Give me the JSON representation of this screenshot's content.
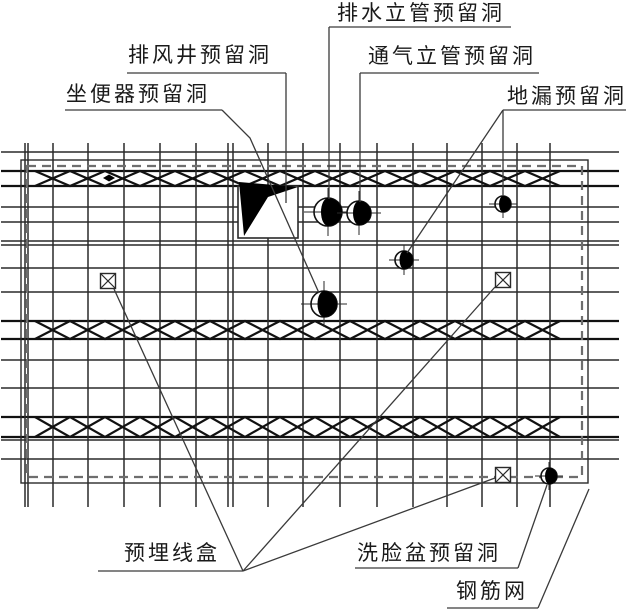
{
  "colors": {
    "line": "#2a2a2a",
    "bold_line": "#111111",
    "dashed_border": "#6e6e6e",
    "leader": "#3a3a3a",
    "text": "#1a1a1a",
    "fill": "#000000",
    "background": "#ffffff"
  },
  "labels": [
    {
      "id": "drain-riser-hole-label",
      "text": "排水立管预留洞",
      "tx": 337,
      "ty": 2,
      "underline": [
        329,
        27,
        511,
        27
      ],
      "leaders": [
        [
          [
            329,
            27
          ],
          [
            329,
            199
          ]
        ]
      ]
    },
    {
      "id": "exhaust-shaft-hole-label",
      "text": "排风井预留洞",
      "tx": 128,
      "ty": 44,
      "underline": [
        127,
        73,
        286,
        73
      ],
      "leaders": [
        [
          [
            286,
            73
          ],
          [
            286,
            203
          ]
        ]
      ]
    },
    {
      "id": "vent-riser-hole-label",
      "text": "通气立管预留洞",
      "tx": 368,
      "ty": 45,
      "underline": [
        360,
        73,
        539,
        73
      ],
      "leaders": [
        [
          [
            360,
            73
          ],
          [
            360,
            202
          ]
        ]
      ]
    },
    {
      "id": "toilet-hole-label",
      "text": "坐便器预留洞",
      "tx": 66,
      "ty": 83,
      "underline": [
        65,
        110,
        222,
        110
      ],
      "leaders": [
        [
          [
            222,
            110
          ],
          [
            250,
            138
          ],
          [
            319,
            293
          ]
        ]
      ]
    },
    {
      "id": "floor-drain-hole-label",
      "text": "地漏预留洞",
      "tx": 507,
      "ty": 85,
      "underline": [
        503,
        110,
        626,
        110
      ],
      "leaders": [
        [
          [
            503,
            110
          ],
          [
            503,
            196
          ]
        ],
        [
          [
            503,
            110
          ],
          [
            407,
            253
          ]
        ]
      ]
    },
    {
      "id": "embedded-junction-box-label",
      "text": "预埋线盒",
      "tx": 124,
      "ty": 542,
      "underline": [
        98,
        571,
        243,
        571
      ],
      "leaders": [
        [
          [
            243,
            571
          ],
          [
            114,
            289
          ]
        ],
        [
          [
            243,
            571
          ],
          [
            495,
            287
          ]
        ],
        [
          [
            243,
            571
          ],
          [
            495,
            478
          ]
        ]
      ]
    },
    {
      "id": "washbasin-hole-label",
      "text": "洗脸盆预留洞",
      "tx": 357,
      "ty": 542,
      "underline": [
        355,
        568,
        518,
        568
      ],
      "leaders": [
        [
          [
            518,
            568
          ],
          [
            547,
            485
          ]
        ]
      ]
    },
    {
      "id": "rebar-mesh-label",
      "text": "钢筋网",
      "tx": 456,
      "ty": 580,
      "underline": [
        447,
        608,
        538,
        608
      ],
      "leaders": [
        [
          [
            538,
            608
          ],
          [
            589,
            489
          ]
        ]
      ]
    }
  ],
  "slab": {
    "solid_border": [
      21,
      160,
      588,
      483
    ],
    "dashed_border": [
      27,
      166,
      582,
      477
    ],
    "grid": {
      "verticals": [
        25,
        28,
        53,
        88,
        124,
        160,
        196,
        228,
        233,
        268,
        303,
        340,
        377,
        413,
        447,
        482,
        517,
        550
      ],
      "v_top": 143,
      "v_bottom": 507,
      "horizontals": [
        152,
        207,
        222,
        241,
        245,
        268,
        292,
        360,
        388,
        440,
        459
      ],
      "bold_horizontals": [
        171,
        186,
        321,
        339,
        417,
        437
      ],
      "h_left": 1,
      "h_right": 619
    },
    "truss_bands": [
      {
        "y1": 171,
        "y2": 186
      },
      {
        "y1": 321,
        "y2": 339
      },
      {
        "y1": 417,
        "y2": 437
      }
    ],
    "band_x1": 35,
    "band_x2": 577,
    "band_step": 35,
    "band_dot": {
      "cx": 109,
      "cy": 178,
      "w": 12,
      "h": 7
    }
  },
  "symbols": {
    "holes": [
      {
        "name": "drain-riser-hole",
        "cx": 328,
        "cy": 212,
        "r": 14
      },
      {
        "name": "vent-riser-hole",
        "cx": 359,
        "cy": 213,
        "r": 12
      },
      {
        "name": "floor-drain-hole-1",
        "cx": 503,
        "cy": 204,
        "r": 8
      },
      {
        "name": "floor-drain-hole-2",
        "cx": 404,
        "cy": 260,
        "r": 9
      },
      {
        "name": "toilet-hole",
        "cx": 324,
        "cy": 304,
        "r": 13
      },
      {
        "name": "washbasin-hole",
        "cx": 549,
        "cy": 476,
        "r": 8
      }
    ],
    "junction_boxes": [
      {
        "name": "junction-box-left",
        "cx": 108,
        "cy": 281
      },
      {
        "name": "junction-box-right",
        "cx": 503,
        "cy": 280
      },
      {
        "name": "junction-box-bottom",
        "cx": 503,
        "cy": 475
      }
    ],
    "junction_box_size": 15,
    "exhaust_shaft": {
      "x": 238,
      "y": 186,
      "w": 60,
      "h": 52,
      "flag": [
        [
          239,
          182
        ],
        [
          298,
          187
        ],
        [
          268,
          197
        ],
        [
          244,
          236
        ]
      ]
    }
  }
}
